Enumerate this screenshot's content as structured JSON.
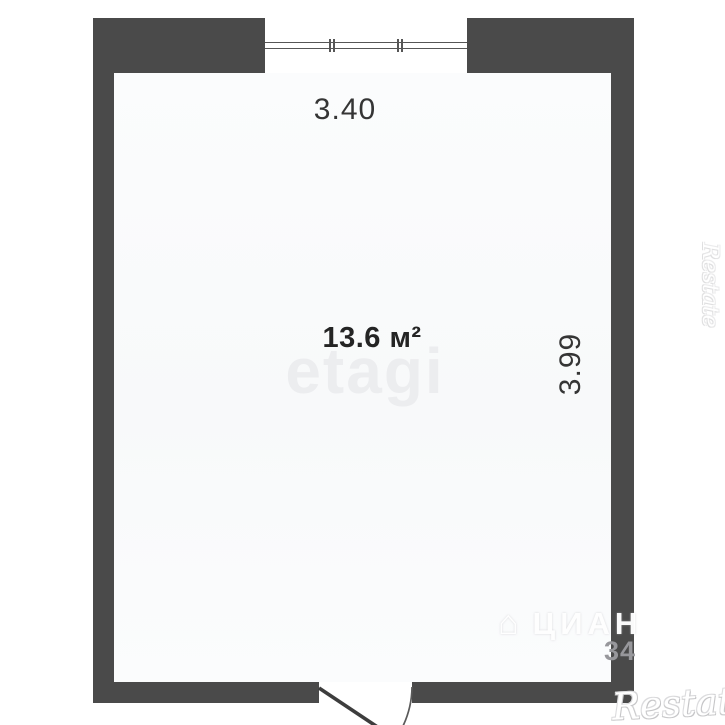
{
  "floor_plan": {
    "room": {
      "area_label": "13.6 м²",
      "width_dimension": "3.40",
      "height_dimension": "3.99"
    },
    "features": {
      "window": "window-top-wall",
      "door": "door-bottom-wall-swing-out"
    },
    "watermarks": {
      "etagi": "etagi",
      "cian": "ЦИАН",
      "cian_house_icon": "⌂",
      "cian_number": "34",
      "restate_bottom": "Restate",
      "restate_side": "Restate"
    },
    "colors": {
      "wall": "#4a4a4a",
      "floor-a": "#fbfcfd",
      "floor-b": "#f8f9fa",
      "door-line": "#3d3d3d",
      "dim-text": "#353535",
      "area-text": "#242424",
      "etagi": "#ecedef",
      "gray-num": "#97979b"
    }
  }
}
